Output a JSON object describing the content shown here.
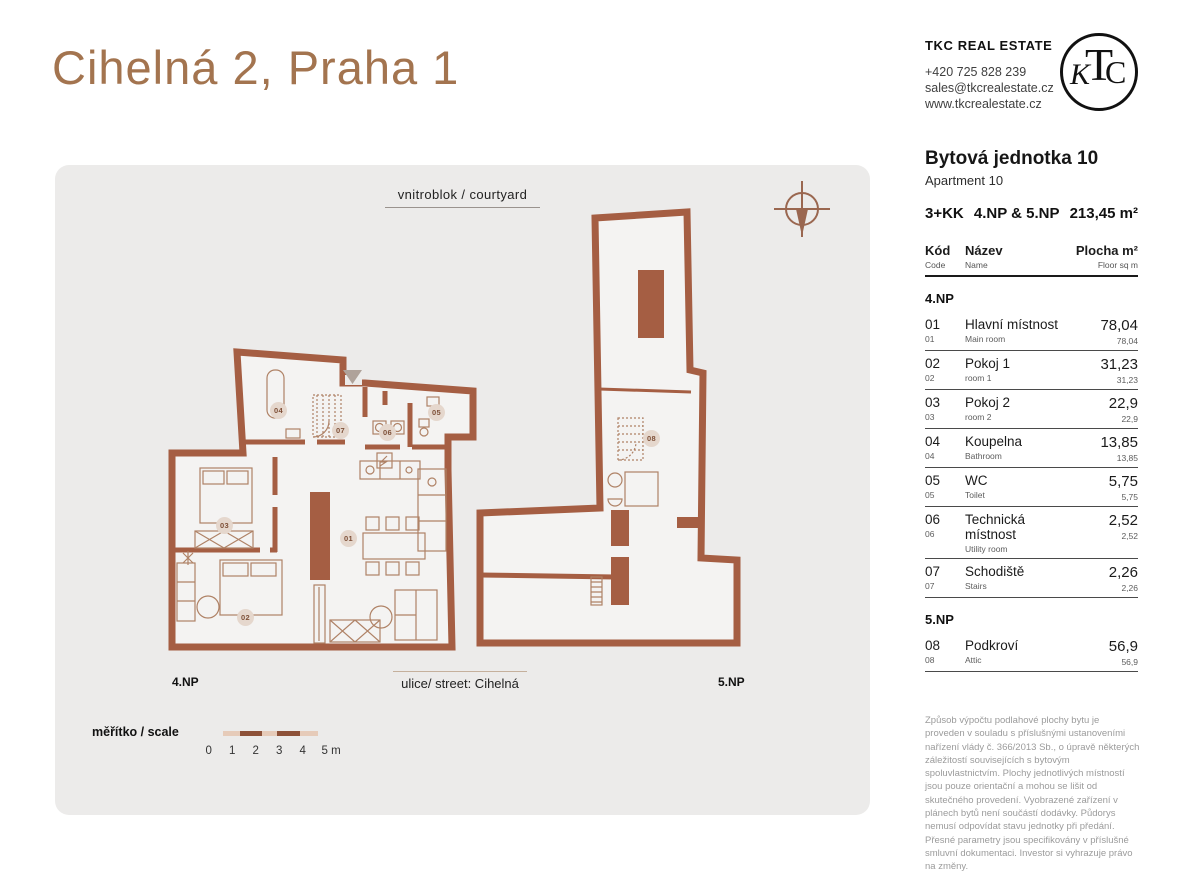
{
  "page": {
    "title": "Cihelná 2, Praha 1"
  },
  "agency": {
    "name": "TKC REAL ESTATE",
    "phone": "+420 725 828 239",
    "email": "sales@tkcrealestate.cz",
    "website": "www.tkcrealestate.cz",
    "logo_monogram": {
      "t": "T",
      "k": "K",
      "c": "C"
    }
  },
  "plan": {
    "courtyard_label": "vnitroblok / courtyard",
    "street_label": "ulice/ street: Cihelná",
    "floor_left_label": "4.NP",
    "floor_right_label": "5.NP",
    "scale_label": "měřítko / scale",
    "scale_ticks": [
      "0",
      "1",
      "2",
      "3",
      "4",
      "5 m"
    ],
    "rooms": [
      "01",
      "02",
      "03",
      "04",
      "05",
      "06",
      "07",
      "08"
    ]
  },
  "unit": {
    "title_cz": "Bytová jednotka 10",
    "title_en": "Apartment 10",
    "layout": "3+KK",
    "floors": "4.NP & 5.NP",
    "total_area": "213,45 m²"
  },
  "table": {
    "headers": {
      "code_cz": "Kód",
      "code_en": "Code",
      "name_cz": "Název",
      "name_en": "Name",
      "area_cz": "Plocha m²",
      "area_en": "Floor sq m"
    },
    "sections": [
      {
        "label": "4.NP",
        "rows": [
          {
            "code": "01",
            "name_cz": "Hlavní místnost",
            "name_en": "Main room",
            "area": "78,04"
          },
          {
            "code": "02",
            "name_cz": "Pokoj 1",
            "name_en": "room 1",
            "area": "31,23"
          },
          {
            "code": "03",
            "name_cz": "Pokoj 2",
            "name_en": "room 2",
            "area": "22,9"
          },
          {
            "code": "04",
            "name_cz": "Koupelna",
            "name_en": "Bathroom",
            "area": "13,85"
          },
          {
            "code": "05",
            "name_cz": "WC",
            "name_en": "Toilet",
            "area": "5,75"
          },
          {
            "code": "06",
            "name_cz": "Technická místnost",
            "name_en": "Utility room",
            "area": "2,52"
          },
          {
            "code": "07",
            "name_cz": "Schodiště",
            "name_en": "Stairs",
            "area": "2,26"
          }
        ]
      },
      {
        "label": "5.NP",
        "rows": [
          {
            "code": "08",
            "name_cz": "Podkroví",
            "name_en": "Attic",
            "area": "56,9"
          }
        ]
      }
    ]
  },
  "disclaimer": "Způsob výpočtu podlahové plochy bytu je proveden v souladu s příslušnými ustanoveními nařízení vlády č. 366/2013 Sb., o úpravě některých záležitostí souvisejících s bytovým spoluvlastnictvím. Plochy jednotlivých místností jsou pouze orientační a mohou se lišit od skutečného provedení. Vyobrazené zařízení v plánech bytů není součástí dodávky. Půdorys nemusí odpovídat stavu jednotky při předání. Přesné parametry jsou specifikovány v příslušné smluvní dokumentaci. Investor si vyhrazuje právo na změny.",
  "colors": {
    "title_brown": "#A3744F",
    "wall_brown": "#A55E43",
    "furniture_brown": "#AF8266",
    "panel_bg": "#ECEBEA",
    "floor_bg": "#F4F3F2",
    "badge_bg": "#E5D7CD",
    "scale_light": "#E6CBB9",
    "scale_dark": "#8D5138"
  }
}
